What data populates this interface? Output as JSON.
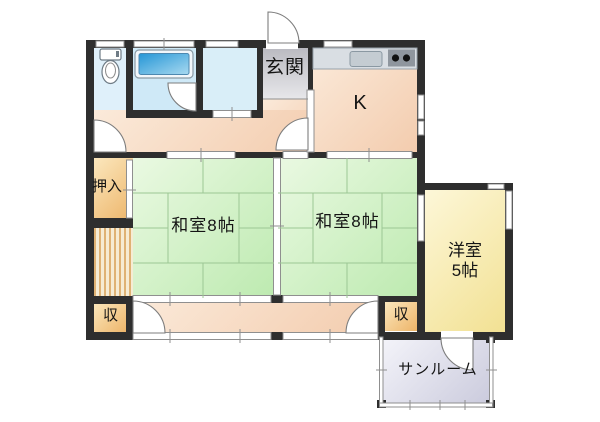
{
  "type": "floorplan",
  "rooms": {
    "genkan": "玄関",
    "kitchen": "K",
    "washitsu_left": "和室8帖",
    "washitsu_right": "和室8帖",
    "yoshitsu_line1": "洋室",
    "yoshitsu_line2": "5帖",
    "oshiire": "押入",
    "storage_left": "収",
    "storage_right": "収",
    "sunroom": "サンルーム"
  },
  "fixtures": {
    "toilet": "toilet-icon",
    "bathtub": "bathtub-icon",
    "sink": "sink-icon",
    "stove": "stove-icon"
  },
  "colors": {
    "wall": "#2e2e2e",
    "tatami-line": "#9cc794",
    "tat-a": "#eaf9e2",
    "tat-b": "#bdeab0",
    "peach-a": "#fbeada",
    "peach-b": "#f3ccae",
    "orange-a": "#fbe7bd",
    "orange-b": "#edb468",
    "yellow-a": "#fdf7d8",
    "yellow-b": "#f2e193",
    "lav-a": "#f3f3f9",
    "lav-b": "#cbcbdd",
    "toilet-floor": "#dff0fa",
    "bath-floor": "#cfe9f7",
    "wash-floor": "#d9eef8",
    "genkan-a": "#b9b9c0",
    "genkan-b": "#e7e7ea",
    "tub-a": "#2596d6",
    "tub-b": "#a8d9f0",
    "counter": "#d9dee3",
    "stove": "#8f969e",
    "sym-line": "#8f8f8f",
    "arc-line": "#7d7d7d",
    "stripe-a": "#dfb274",
    "stripe-b": "#f6ecd4"
  }
}
